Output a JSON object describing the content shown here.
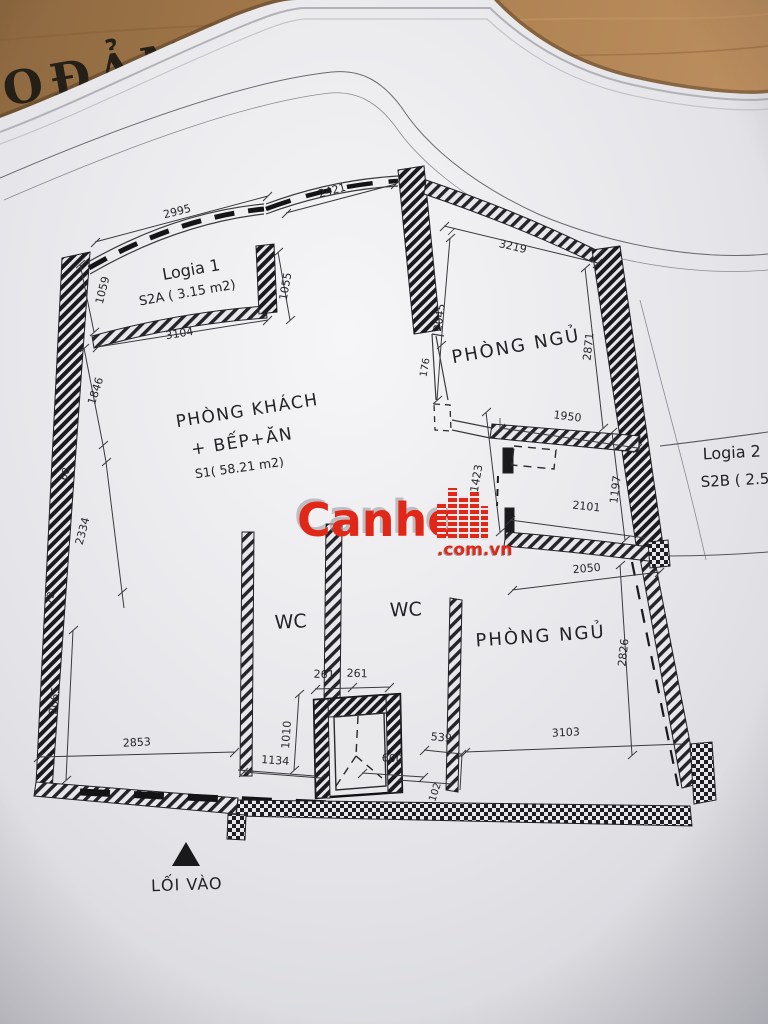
{
  "photo": {
    "desk_text": "OĐẢM"
  },
  "watermark": {
    "brand": "Canho",
    "suffix": ".com.vn"
  },
  "plan": {
    "colors": {
      "ink": "#2a2a2e",
      "watermark_red": "#e02718",
      "paper": "#e6e6ea",
      "wood": "#ab7e4e"
    },
    "rooms": {
      "logia1": {
        "name": "Logia 1",
        "area": "S2A ( 3.15 m2)"
      },
      "living": {
        "line1": "PHÒNG KHÁCH",
        "line2": "+ BẾP+ĂN",
        "area": "S1( 58.21 m2)"
      },
      "bedroom_top": "PHÒNG NGỦ",
      "bedroom_bottom": "PHÒNG NGỦ",
      "wc_left": "WC",
      "wc_right": "WC",
      "logia2": {
        "name": "Logia 2",
        "area": "S2B ( 2.51"
      },
      "entrance": "LỐI VÀO"
    },
    "dims": {
      "d2995": "2995",
      "d2421": "2421",
      "d3219": "3219",
      "d1059": "1059",
      "d1055": "1055",
      "d3104": "3104",
      "d2045": "2045",
      "d176": "176",
      "d2871": "2871",
      "d1950": "1950",
      "d1423": "1423",
      "d2101": "2101",
      "d1197": "1197",
      "d2050": "2050",
      "d1846": "1846",
      "d68": "68",
      "d2334": "2334",
      "d72": "72",
      "d2065": "2065",
      "d2853": "2853",
      "d1134": "1134",
      "d1010": "1010",
      "d261a": "261",
      "d261b": "261",
      "d600": "600",
      "d539": "539",
      "d102": "102",
      "d3103": "3103",
      "d2826": "2826"
    }
  }
}
